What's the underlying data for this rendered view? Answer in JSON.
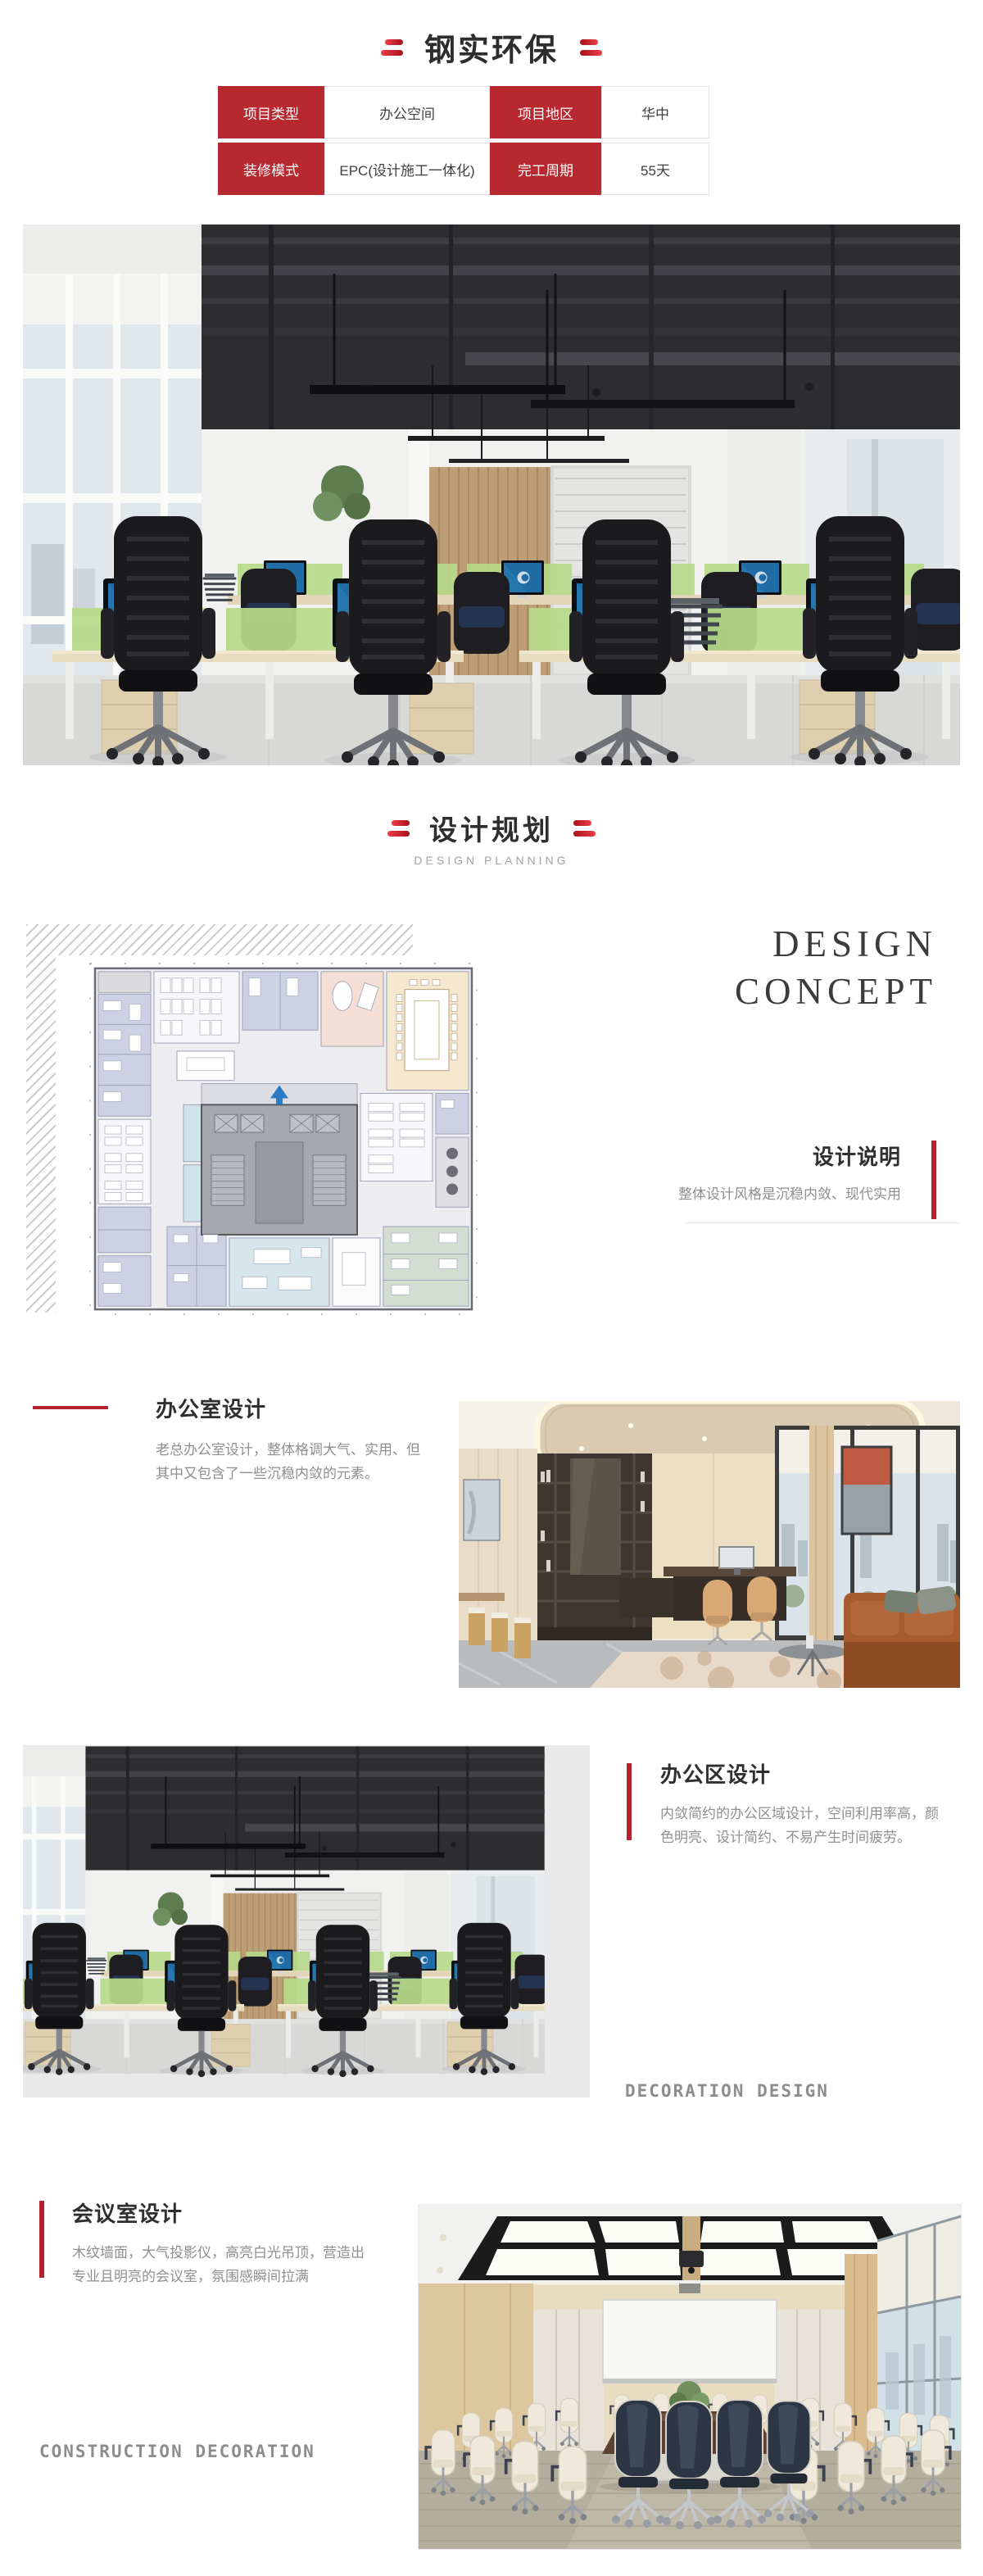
{
  "header": {
    "title": "钢实环保"
  },
  "info_table": {
    "cells": [
      {
        "text": "项目类型"
      },
      {
        "text": "办公空间"
      },
      {
        "text": "项目地区"
      },
      {
        "text": "华中"
      },
      {
        "text": "装修模式"
      },
      {
        "text": "EPC(设计施工一体化)"
      },
      {
        "text": "完工周期"
      },
      {
        "text": "55天"
      }
    ]
  },
  "planning": {
    "title": "设计规划",
    "subtitle": "DESIGN PLANNING"
  },
  "concept": {
    "line1": "DESIGN",
    "line2": "CONCEPT"
  },
  "design_note": {
    "title": "设计说明",
    "desc": "整体设计风格是沉稳内敛、现代实用"
  },
  "office_room": {
    "title": "办公室设计",
    "desc": "老总办公室设计，整体格调大气、实用、但其中又包含了一些沉稳内敛的元素。"
  },
  "office_area": {
    "title": "办公区设计",
    "desc": "内敛简约的办公区域设计，空间利用率高，颜色明亮、设计简约、不易产生时间疲劳。",
    "watermark": "DECORATION DESIGN"
  },
  "meeting_room": {
    "title": "会议室设计",
    "desc": "木纹墙面，大气投影仪，高亮白光吊顶，营造出专业且明亮的会议室，氛围感瞬间拉满",
    "watermark": "CONSTRUCTION DECORATION"
  },
  "colors": {
    "accent_red": "#b5212e",
    "table_red": "#b7282f",
    "text_dark": "#2f2f2f",
    "text_gray": "#8f8f8f"
  }
}
